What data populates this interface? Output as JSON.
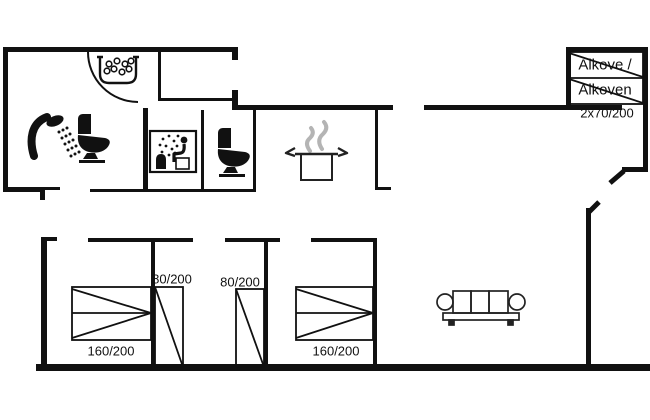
{
  "floorplan": {
    "colors": {
      "background": "#ffffff",
      "walls": "#111111",
      "furniture_outline": "#222222",
      "steam_gray": "#b4b4b4",
      "text": "#111111"
    },
    "labels": {
      "alkove_line1": "Alkove /",
      "alkove_line2": "Alkoven",
      "alkove_size": "2x70/200",
      "bed_single_left": "80/200",
      "bed_single_middle": "80/200",
      "bed_double_left": "160/200",
      "bed_double_right": "160/200"
    },
    "icons": [
      "whirlpool-icon",
      "shower-icon",
      "toilet-icon",
      "sauna-icon",
      "cooking-pot-icon",
      "sofa-icon",
      "door-arc",
      "alcove-bed",
      "double-bed",
      "single-bed"
    ]
  }
}
